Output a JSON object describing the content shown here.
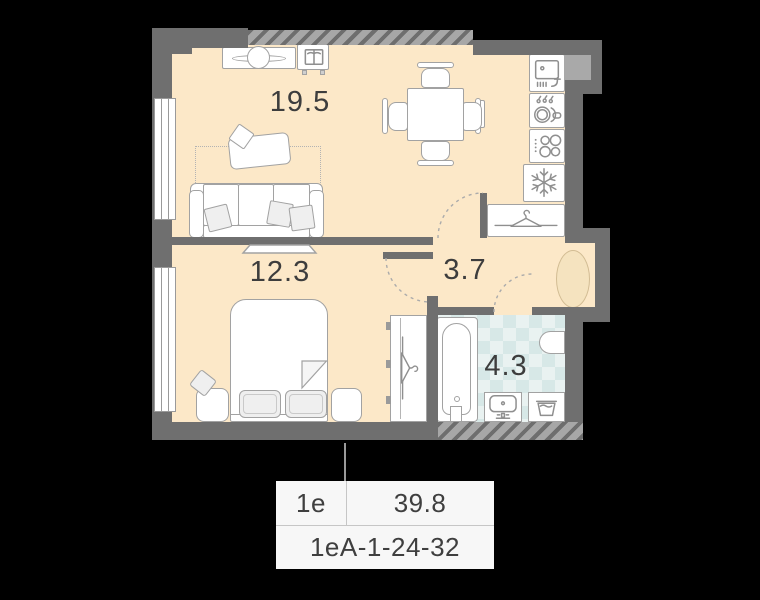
{
  "plan": {
    "rooms": {
      "living_kitchen": {
        "area": "19.5"
      },
      "bedroom": {
        "area": "12.3"
      },
      "hallway": {
        "area": "3.7"
      },
      "bathroom": {
        "area": "4.3"
      }
    },
    "footer": {
      "unit_type": "1е",
      "total_area": "39.8",
      "unit_code": "1еА-1-24-32"
    },
    "icons": [
      "sink-icon",
      "dishwasher-icon",
      "cooktop-icon",
      "snowflake-icon",
      "hanger-icon",
      "book-icon"
    ],
    "colors": {
      "floor": "#fce8c8",
      "wall": "#6f6f6f",
      "wall_light": "#a9a9a9",
      "tile": "#d7e8e7",
      "rug": "#f5e3bf",
      "text": "#3d3d3d",
      "footer_bg": "#f7f7f7",
      "background": "#000000"
    }
  }
}
